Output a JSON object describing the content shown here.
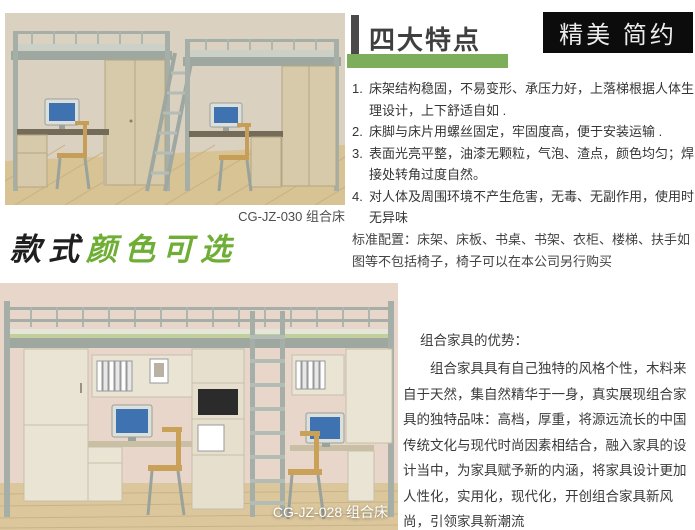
{
  "header": {
    "section_title": "四大特点",
    "badge_label": "精美 简约",
    "accent_green": "#7dae5b",
    "bar_color": "#4a4a4a",
    "badge_bg": "#0c0c0c"
  },
  "features": {
    "items": [
      {
        "num": "1.",
        "text": "床架结构稳固，不易变形、承压力好，上落梯根据人体生理设计，上下舒适自如 ."
      },
      {
        "num": "2.",
        "text": "床脚与床片用螺丝固定，牢固度高，便于安装运输 ."
      },
      {
        "num": "3.",
        "text": "表面光亮平整，油漆无颗粒，气泡、渣点，颜色均匀；焊接处转角过度自然。"
      },
      {
        "num": "4.",
        "text": "对人体及周围环境不产生危害，无毒、无副作用，使用时无异味"
      }
    ]
  },
  "standard_config": "标准配置：床架、床板、书桌、书架、衣柜、楼梯、扶手如图等不包括椅子，椅子可以在本公司另行购买",
  "products": [
    {
      "code_caption": "CG-JZ-030 组合床"
    },
    {
      "code_caption": "CG-JZ-028 组合床"
    }
  ],
  "slogan": {
    "part_black": "款式",
    "part_green": "颜色可选",
    "green_color": "#6fae35"
  },
  "advantages": {
    "heading": "组合家具的优势：",
    "paragraph": "组合家具具有自己独特的风格个性，木料来自于天然，集自然精华于一身，真实展现组合家具的独特品味：高档，厚重，将源远流长的中国传统文化与现代时尚因素相结合，融入家具的设计当中，为家具赋予新的内涵，将家具设计更加人性化，实用化，现代化，开创组合家具新风尚，引领家具新潮流"
  }
}
